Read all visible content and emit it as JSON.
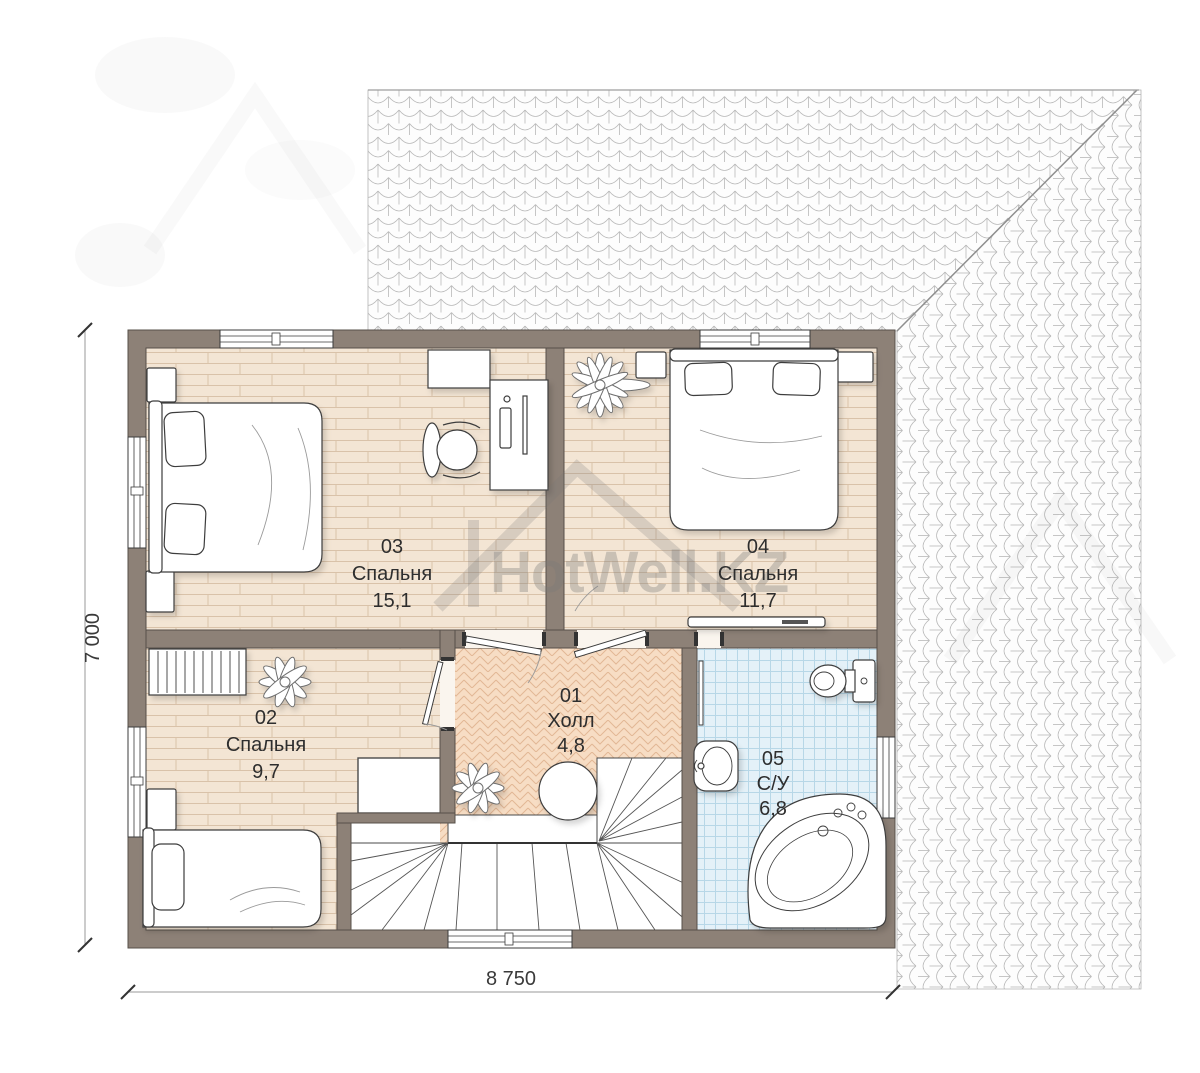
{
  "watermark": {
    "brand": "HotWell.KZ"
  },
  "dimensions": {
    "width_label": "8 750",
    "height_label": "7 000"
  },
  "rooms": [
    {
      "number": "03",
      "name": "Спальня",
      "area": "15,1"
    },
    {
      "number": "04",
      "name": "Спальня",
      "area": "11,7"
    },
    {
      "number": "02",
      "name": "Спальня",
      "area": "9,7"
    },
    {
      "number": "01",
      "name": "Холл",
      "area": "4,8"
    },
    {
      "number": "05",
      "name": "С/У",
      "area": "6,8"
    }
  ],
  "colors": {
    "wall": "#8d8177",
    "wood_floor": "#f3e5d4",
    "wood_floor_line": "#d9c2a9",
    "hall_floor": "#f7ddc4",
    "hall_floor_line": "#e2b795",
    "bath_floor": "#e4f1f8",
    "bath_floor_line": "#b7d7e7",
    "roof_line": "#b4b4b4",
    "label_text": "#2e2e2e"
  }
}
